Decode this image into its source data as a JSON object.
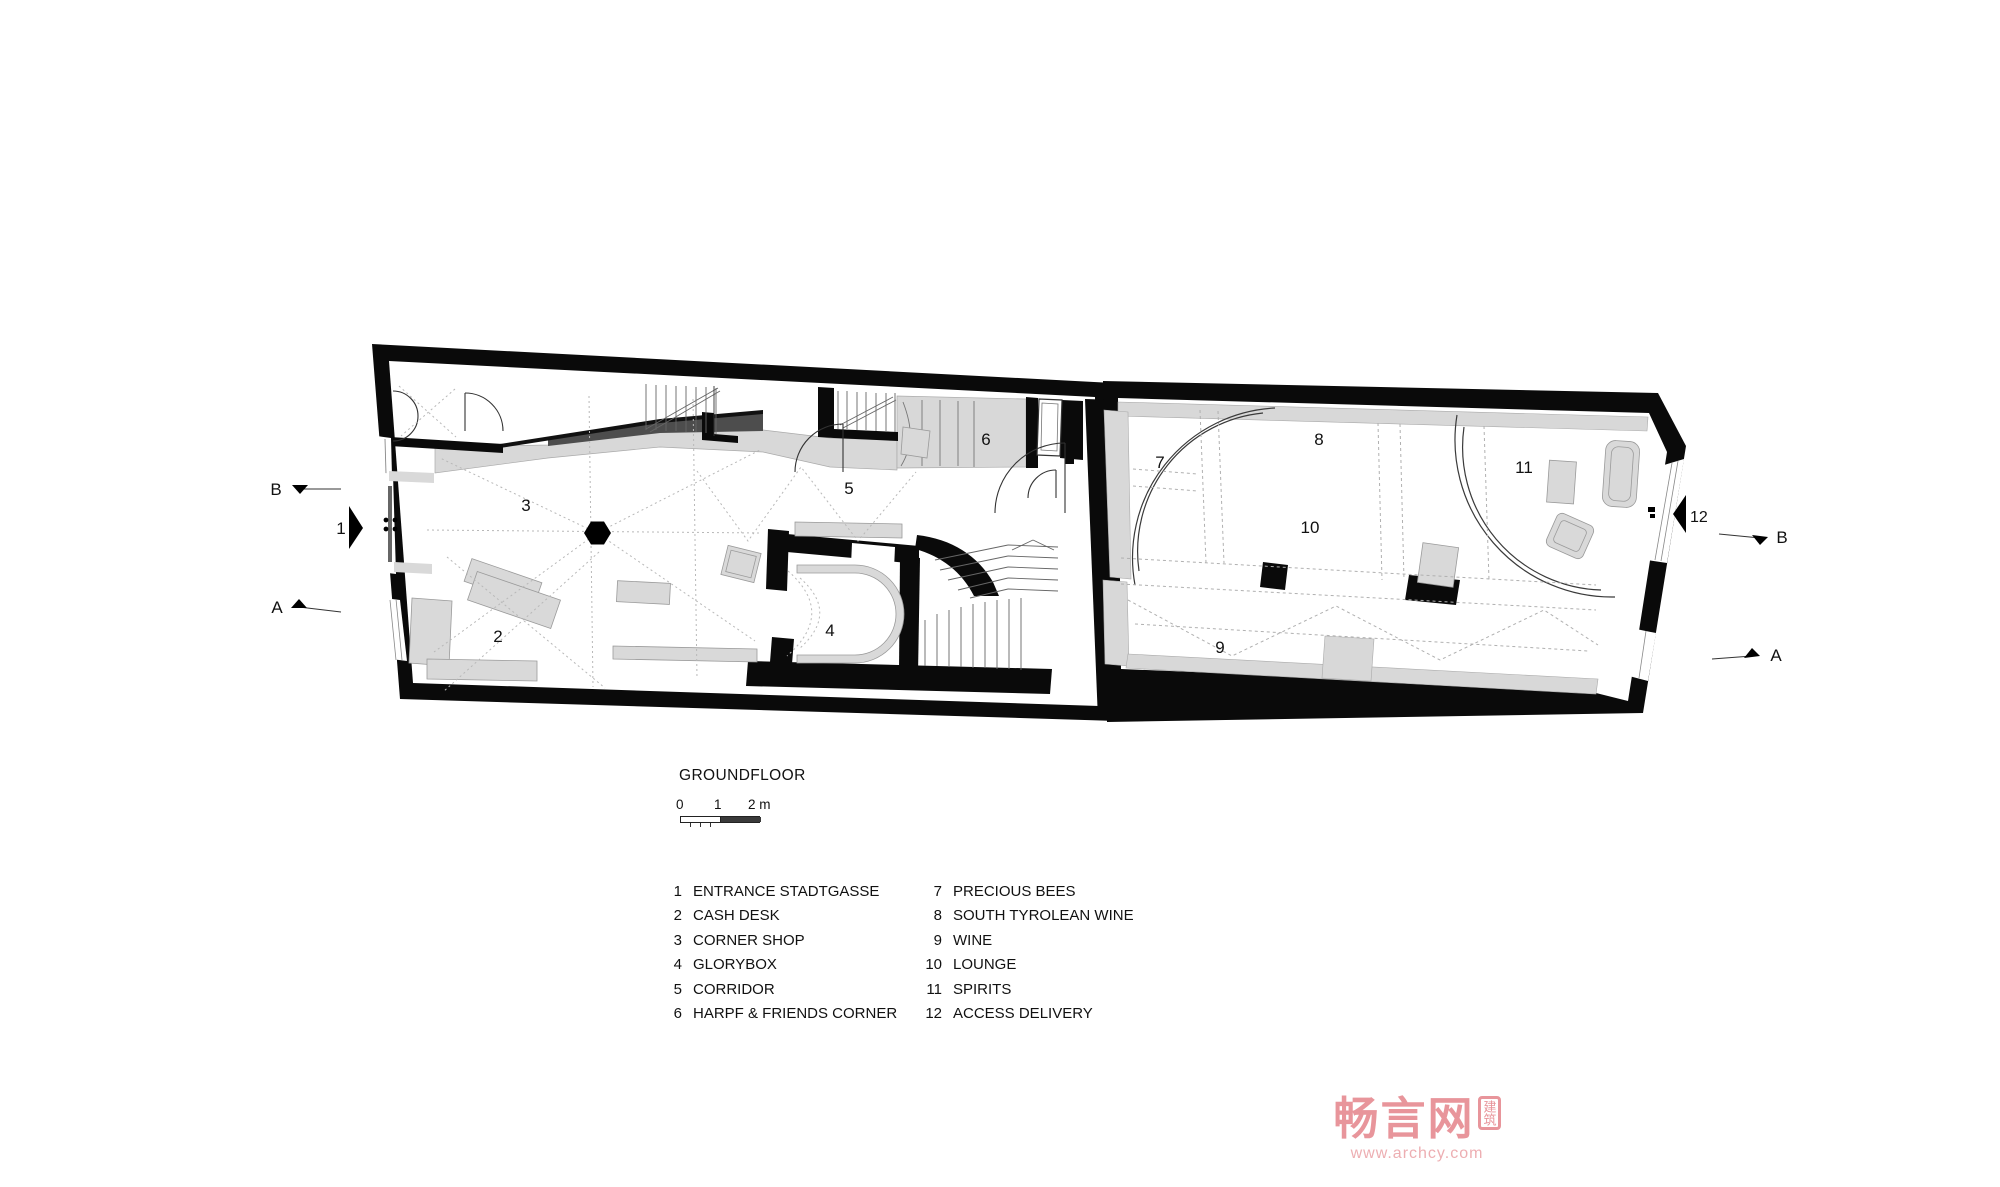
{
  "title": "GROUNDFLOOR",
  "scale_bar": {
    "labels": [
      "0",
      "1",
      "2 m"
    ]
  },
  "plan": {
    "rooms": [
      {
        "num": "2"
      },
      {
        "num": "3"
      },
      {
        "num": "4"
      },
      {
        "num": "5"
      },
      {
        "num": "6"
      },
      {
        "num": "7"
      },
      {
        "num": "8"
      },
      {
        "num": "9"
      },
      {
        "num": "10"
      },
      {
        "num": "11"
      }
    ],
    "markers": {
      "section_b": "B",
      "section_a": "A",
      "entrance": "1",
      "access_delivery": "12"
    }
  },
  "legend": {
    "col1": [
      {
        "num": "1",
        "label": "ENTRANCE STADTGASSE"
      },
      {
        "num": "2",
        "label": "CASH DESK"
      },
      {
        "num": "3",
        "label": "CORNER SHOP"
      },
      {
        "num": "4",
        "label": "GLORYBOX"
      },
      {
        "num": "5",
        "label": "CORRIDOR"
      },
      {
        "num": "6",
        "label": "HARPF & FRIENDS CORNER"
      }
    ],
    "col2": [
      {
        "num": "7",
        "label": "PRECIOUS BEES"
      },
      {
        "num": "8",
        "label": "SOUTH TYROLEAN WINE"
      },
      {
        "num": "9",
        "label": "WINE"
      },
      {
        "num": "10",
        "label": "LOUNGE"
      },
      {
        "num": "11",
        "label": "SPIRITS"
      },
      {
        "num": "12",
        "label": "ACCESS DELIVERY"
      }
    ]
  },
  "watermark": {
    "logo": "畅言网",
    "seal": "建筑",
    "url": "www.archcy.com"
  },
  "colors": {
    "wall": "#0a0a0a",
    "furniture": "#d9d9d9",
    "band_dark": "#4d4d4d",
    "watermark": "#e8959b"
  }
}
